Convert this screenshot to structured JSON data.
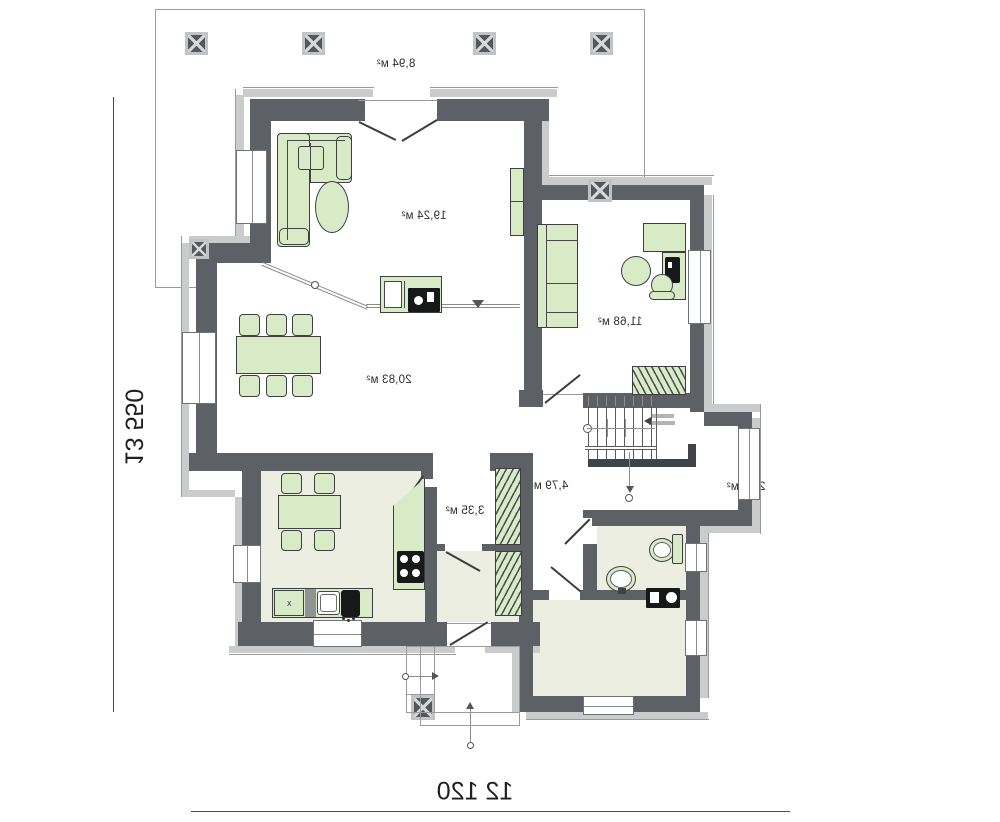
{
  "dimensions": {
    "height_label": "13 550",
    "width_label": "12 120"
  },
  "terrace": {
    "area_label": "8,94 м²"
  },
  "rooms": {
    "living": {
      "area_label": "19,24 м²"
    },
    "dining": {
      "area_label": "20,83 м²"
    },
    "bedroom": {
      "area_label": "11,68 м²"
    },
    "kitchen": {
      "area_label": "9,92 м²"
    },
    "pantry": {
      "area_label": "3,35 м²"
    },
    "closet": {
      "area_label": "2,75 м²"
    },
    "hall": {
      "area_label": "4,79 м²"
    },
    "stair_hall": {
      "area_label": "2,99 м²"
    },
    "wc": {
      "area_label": "2,63 м²"
    },
    "utility": {
      "area_label": "6,91 м²"
    }
  },
  "annotations": {
    "kitchen_unit_mark": "x"
  },
  "colors": {
    "wall": "#5d6165",
    "insulation": "#cacbcd",
    "furniture_fill": "#d9eac7",
    "floor_tint": "#eceee2",
    "appliance_black": "#17181a"
  }
}
